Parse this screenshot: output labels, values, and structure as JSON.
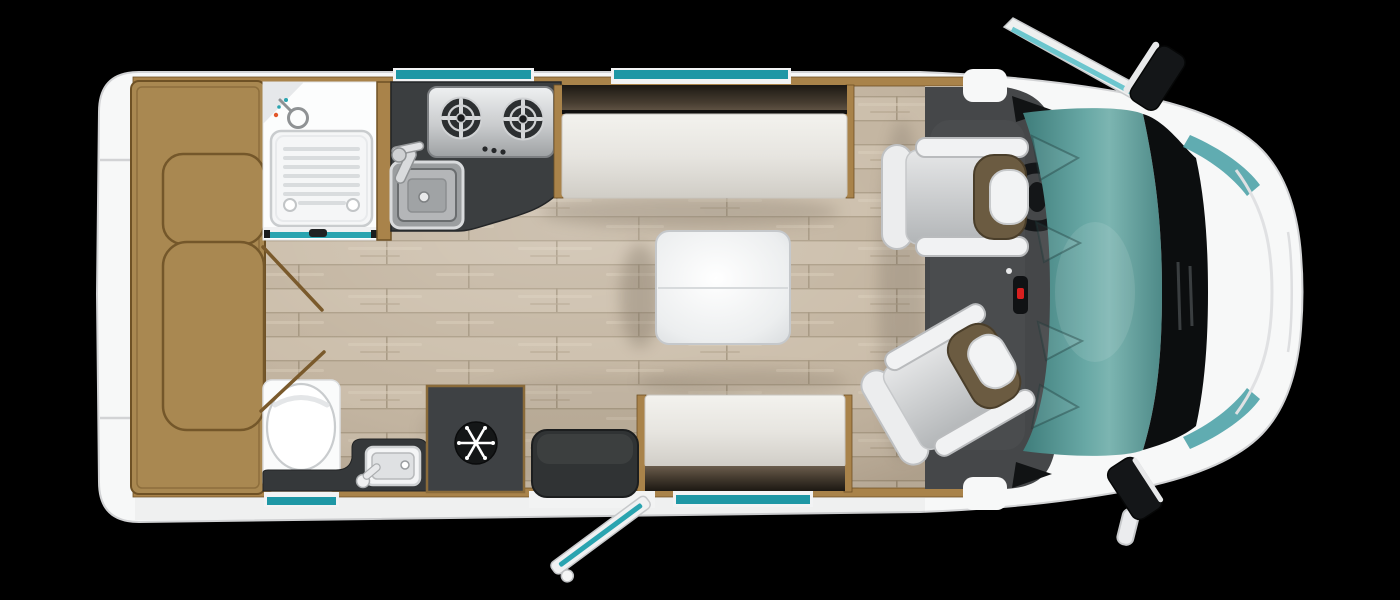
{
  "floorplan": {
    "title": "Motorhome floorplan (top view)",
    "background": "#000000",
    "colors": {
      "body_white": "#f7f8f8",
      "outline_grey": "#d2d3d5",
      "wall_tan": "#a9834a",
      "wood_base": "#c6b8a3",
      "lounge_tan": "#a98851",
      "counter_charcoal": "#3b3e40",
      "cab_floor": "#454749",
      "window_teal": "#1e97a5",
      "door_teal": "#2aa4b0",
      "glass_teal": "#68a8a5",
      "cushion_cream": "#e9e7e1",
      "backrest_brown": "#463c30",
      "seat_olive": "#6b5b41",
      "fixture_dark": "#303334",
      "fridge_dark": "#3e4144",
      "accent_red": "#d81f1f"
    },
    "fixtures": {
      "vehicle_body": "Motorhome body shell",
      "rear_lounge": "Rear lounge seating",
      "shower_room": "Shower room",
      "shower_tray": "Shower tray",
      "shower_head": "Shower head",
      "shower_door": "Sliding shower door",
      "kitchen_counter": "Kitchen worktop",
      "hob": "Two-burner gas hob",
      "kitchen_sink": "Kitchen sink with tap",
      "fridge": "Fridge",
      "toilet": "Toilet",
      "washbasin": "Washbasin with tap",
      "vanity": "Washroom vanity unit",
      "dinette_table": "Folding dinette table",
      "bench_seat_top": "Dinette bench seat (offside)",
      "bench_seat_bottom": "Dinette bench seat (nearside)",
      "entry_step": "Entrance step mat",
      "entry_door": "Entrance door shown open",
      "door_swing": "Washroom door swing",
      "window": "Window",
      "cab": "Driving cab",
      "driver_seat": "Swivel cab seat (driver)",
      "passenger_seat": "Swivel cab seat (passenger)",
      "steering_wheel": "Steering wheel",
      "gear_lever": "Gear lever",
      "windscreen": "Windscreen",
      "mirror_top": "Door mirror (offside)",
      "mirror_bottom": "Door mirror (nearside)",
      "bonnet": "Cab bonnet"
    }
  }
}
